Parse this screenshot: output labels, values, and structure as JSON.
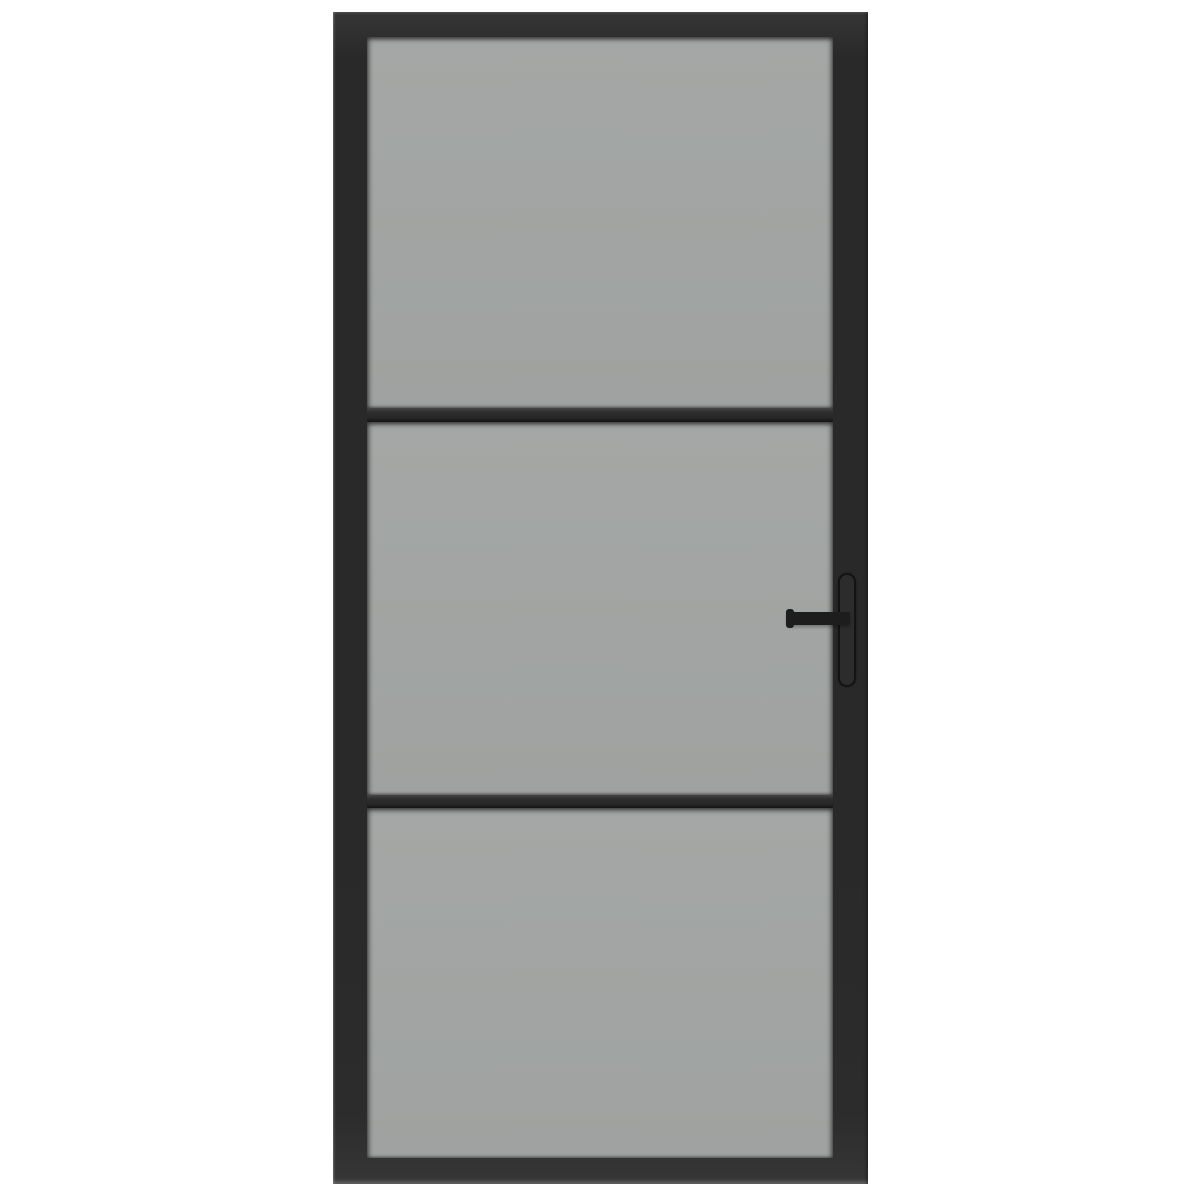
{
  "scene": {
    "kind": "product-photo",
    "subject": "Interior door with matte black metal frame and smoke-grey tinted glass",
    "background": "plain white",
    "door": {
      "frame_finish": "matte black",
      "glass_tint": "smoke grey",
      "glass_panels": 3,
      "horizontal_bars": 2,
      "handle": {
        "type": "lever on long backplate",
        "side": "right",
        "finish": "matte black"
      }
    }
  },
  "colors": {
    "bg": "#ffffff",
    "frame": "#292929",
    "frame-hi": "#363636",
    "glass": "#9fa2a0",
    "glass-light": "#a4a7a5",
    "bar-hi": "#454545",
    "bar-lo": "#141414",
    "backplate": "#2c2c2c",
    "lever": "#1d1d1d"
  }
}
